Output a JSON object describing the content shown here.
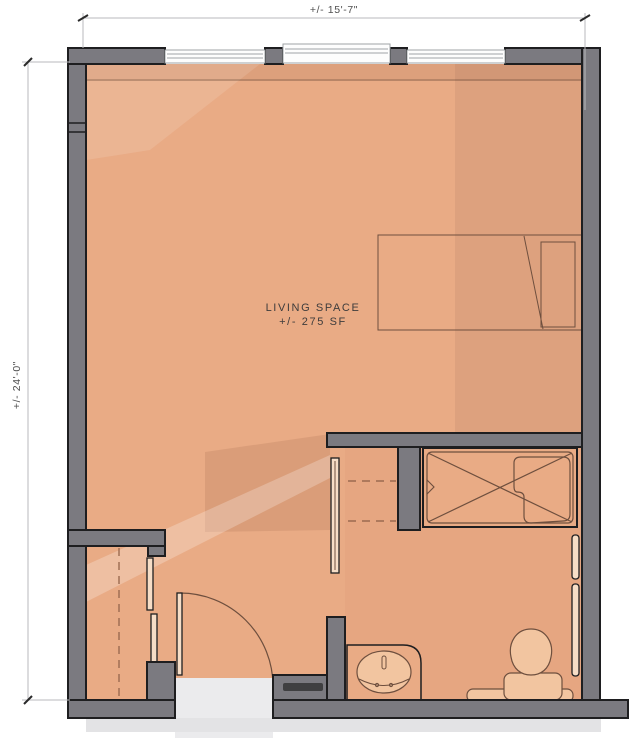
{
  "dimensions": {
    "top": "+/- 15'-7\"",
    "left": "+/- 24'-0\""
  },
  "room": {
    "label": "LIVING SPACE",
    "area": "+/- 275 SF"
  },
  "colors": {
    "floor": "#e9ab85",
    "floor_light": "#f2c5a0",
    "wall": "#7b7a80",
    "outline": "#1e1e20",
    "furniture_line": "#6e4f3e",
    "dashed_line": "#9b6a50",
    "fixture_fill": "#f6ddc6",
    "window": "#fdfdfd",
    "window_frame": "#9fa3a6",
    "corridor": "#ebebed",
    "shadow_strip": "#e3e3e5",
    "threshold": "#3f3f41",
    "dim_line": "#b9b9bd",
    "dim_tick": "#2a2a2a",
    "dim_text": "#4f4f4f",
    "room_text": "#3e3c3c"
  }
}
